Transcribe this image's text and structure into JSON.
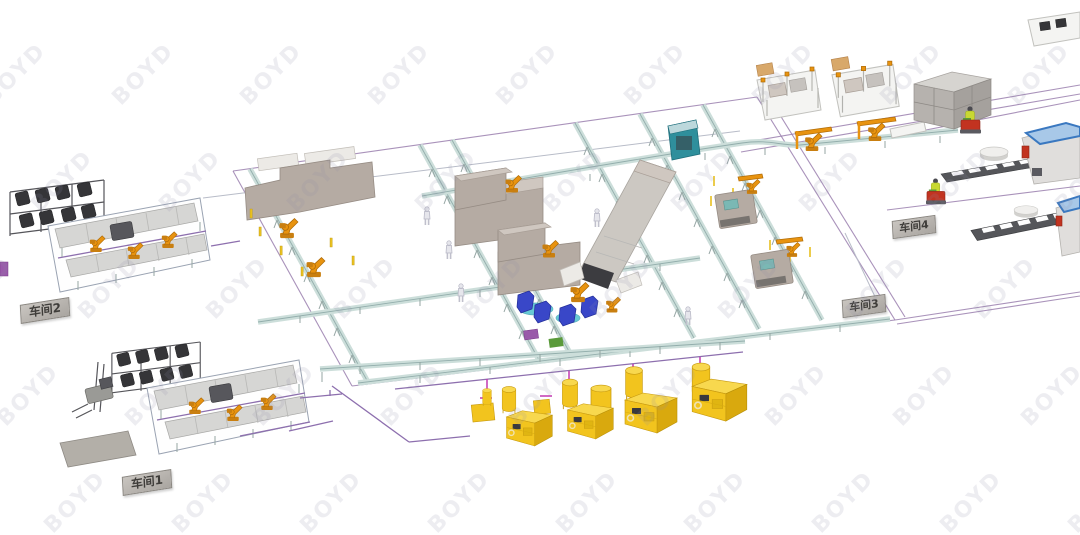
{
  "watermark": {
    "text": "BOYD"
  },
  "labels": {
    "workshop1": "车间1",
    "workshop2": "车间2",
    "workshop3": "车间3",
    "workshop4": "车间4"
  },
  "colors": {
    "background": "#ffffff",
    "watermark": "#8f8da8",
    "boundary_line": "#9a7fae",
    "pipe_purple": "#8d6fae",
    "pipe_magenta": "#c238b0",
    "conveyor_deck": "#ccdeda",
    "conveyor_rail": "#93aeac",
    "robot_orange": "#e8930f",
    "equipment_yellow": "#f2c41e",
    "machine_taupe": "#b5aba3",
    "rack_dark": "#353538",
    "cart_red": "#c23320",
    "safety_vest": "#c8d832",
    "machine_blue": "#3947c8",
    "frame_blue": "#3a78c0",
    "teal_machine": "#2f8f9c"
  }
}
